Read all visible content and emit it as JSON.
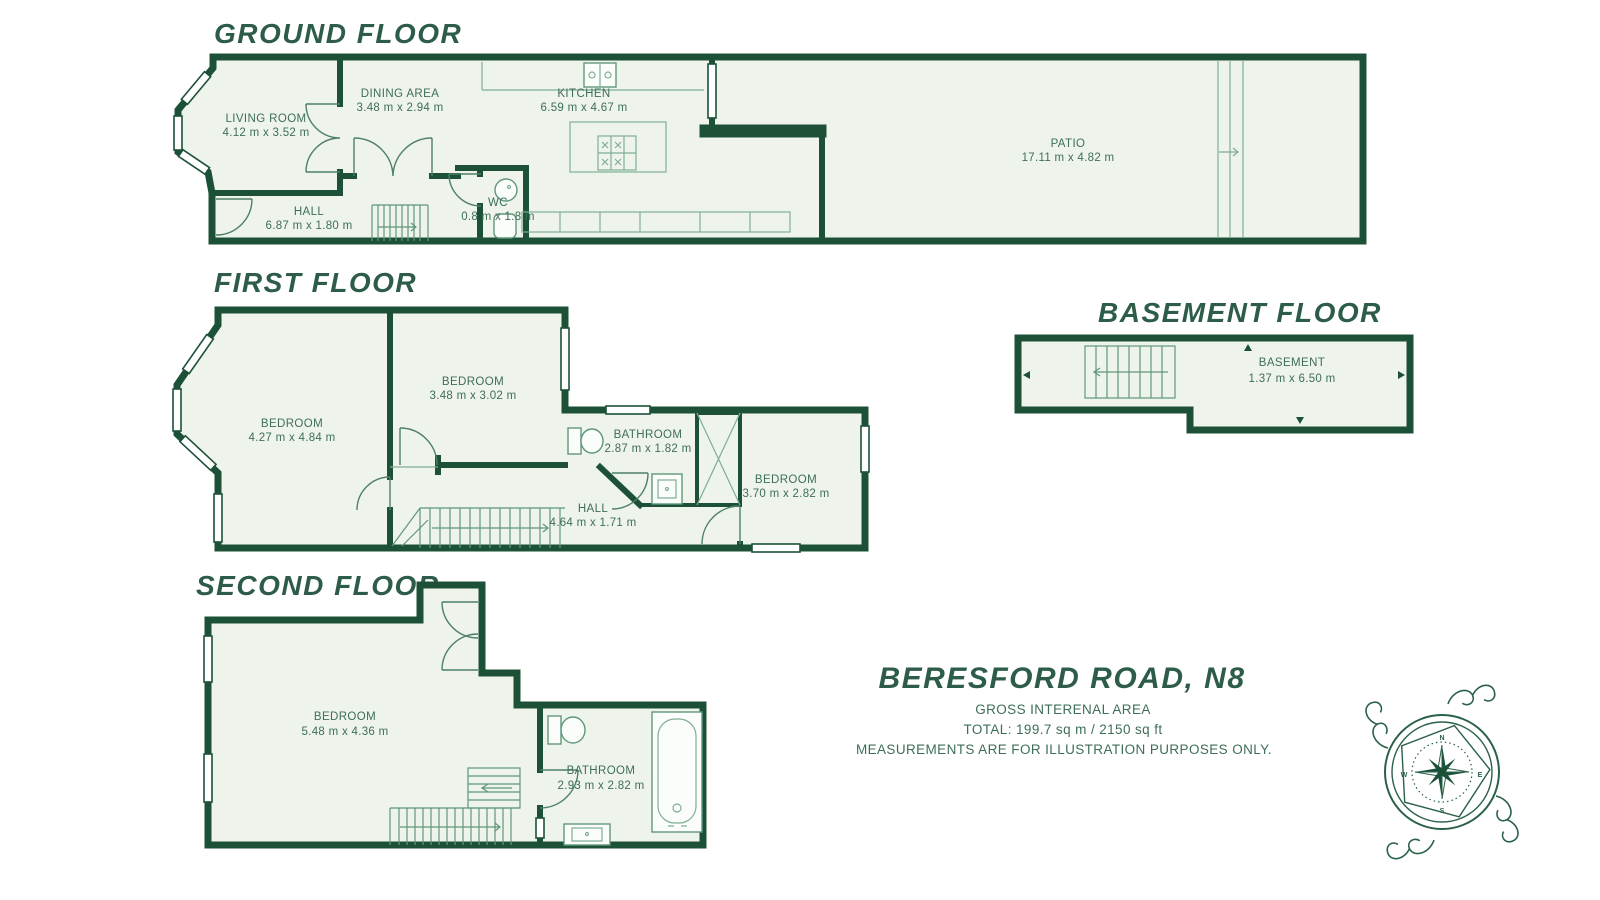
{
  "colors": {
    "wall_green": "#1c5138",
    "title_green": "#2d5c48",
    "label_green": "#3e6e56",
    "room_fill": "#eef3ec",
    "fixture_green": "#5f977b",
    "background": "#ffffff"
  },
  "floors": {
    "ground": {
      "title": "GROUND FLOOR",
      "rooms": {
        "living": {
          "name": "LIVING ROOM",
          "dims": "4.12 m x 3.52 m"
        },
        "dining": {
          "name": "DINING AREA",
          "dims": "3.48 m x 2.94 m"
        },
        "kitchen": {
          "name": "KITCHEN",
          "dims": "6.59 m x 4.67 m"
        },
        "hall": {
          "name": "HALL",
          "dims": "6.87 m x 1.80 m"
        },
        "wc": {
          "name": "WC",
          "dims": "0.8 m x 1.8 m"
        },
        "patio": {
          "name": "PATIO",
          "dims": "17.11 m x 4.82 m"
        }
      }
    },
    "first": {
      "title": "FIRST FLOOR",
      "rooms": {
        "bedroom1": {
          "name": "BEDROOM",
          "dims": "4.27 m x 4.84 m"
        },
        "bedroom2": {
          "name": "BEDROOM",
          "dims": "3.48 m x 3.02 m"
        },
        "bathroom": {
          "name": "BATHROOM",
          "dims": "2.87 m x 1.82 m"
        },
        "bedroom3": {
          "name": "BEDROOM",
          "dims": "3.70 m x 2.82 m"
        },
        "hall": {
          "name": "HALL",
          "dims": "4.64 m x 1.71 m"
        }
      }
    },
    "basement": {
      "title": "BASEMENT FLOOR",
      "rooms": {
        "basement": {
          "name": "BASEMENT",
          "dims": "1.37 m x 6.50 m"
        }
      }
    },
    "second": {
      "title": "SECOND FLOOR",
      "rooms": {
        "bedroom": {
          "name": "BEDROOM",
          "dims": "5.48 m x 4.36 m"
        },
        "bathroom": {
          "name": "BATHROOM",
          "dims": "2.93 m x 2.82 m"
        }
      }
    }
  },
  "summary": {
    "address": "BERESFORD ROAD, N8",
    "area_label": "GROSS INTERENAL AREA",
    "total": "TOTAL: 199.7 sq m / 2150 sq ft",
    "disclaimer": "MEASUREMENTS ARE FOR ILLUSTRATION PURPOSES ONLY."
  },
  "compass": {
    "north": "N",
    "east": "E",
    "south": "S",
    "west": "W"
  }
}
